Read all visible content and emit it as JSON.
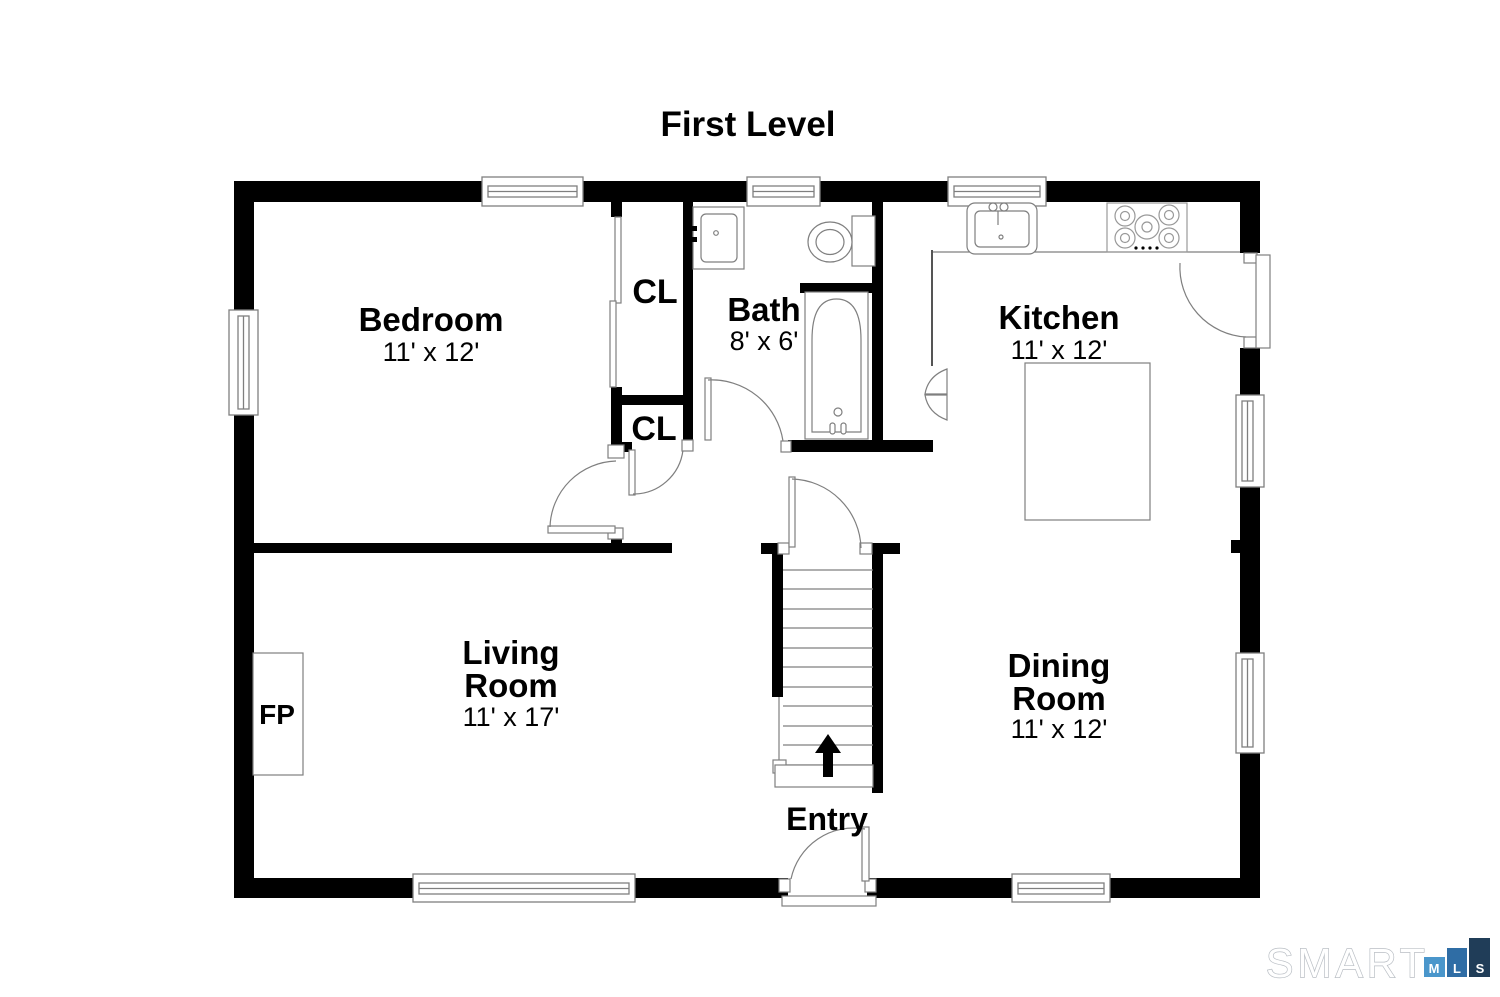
{
  "title": "First Level",
  "rooms": {
    "bedroom": {
      "name": "Bedroom",
      "dims": "11' x 12'"
    },
    "bath": {
      "name": "Bath",
      "dims": "8' x 6'"
    },
    "kitchen": {
      "name": "Kitchen",
      "dims": "11' x 12'"
    },
    "living_room": {
      "name_line1": "Living",
      "name_line2": "Room",
      "dims": "11' x 17'"
    },
    "dining_room": {
      "name_line1": "Dining",
      "name_line2": "Room",
      "dims": "11' x 12'"
    },
    "entry": {
      "name": "Entry"
    },
    "closet_upper": {
      "label": "CL"
    },
    "closet_lower": {
      "label": "CL"
    },
    "fireplace": {
      "label": "FP"
    }
  },
  "logo": {
    "brand": "SMART",
    "mls": {
      "m": "M",
      "l": "L",
      "s": "S"
    },
    "colors": {
      "m": "#4a96cb",
      "l": "#2f6da5",
      "s": "#203d58",
      "brand_outline": "#b9bec4"
    }
  },
  "colors": {
    "wall": "#000000",
    "line": "#7f7f7f",
    "background": "#ffffff"
  }
}
